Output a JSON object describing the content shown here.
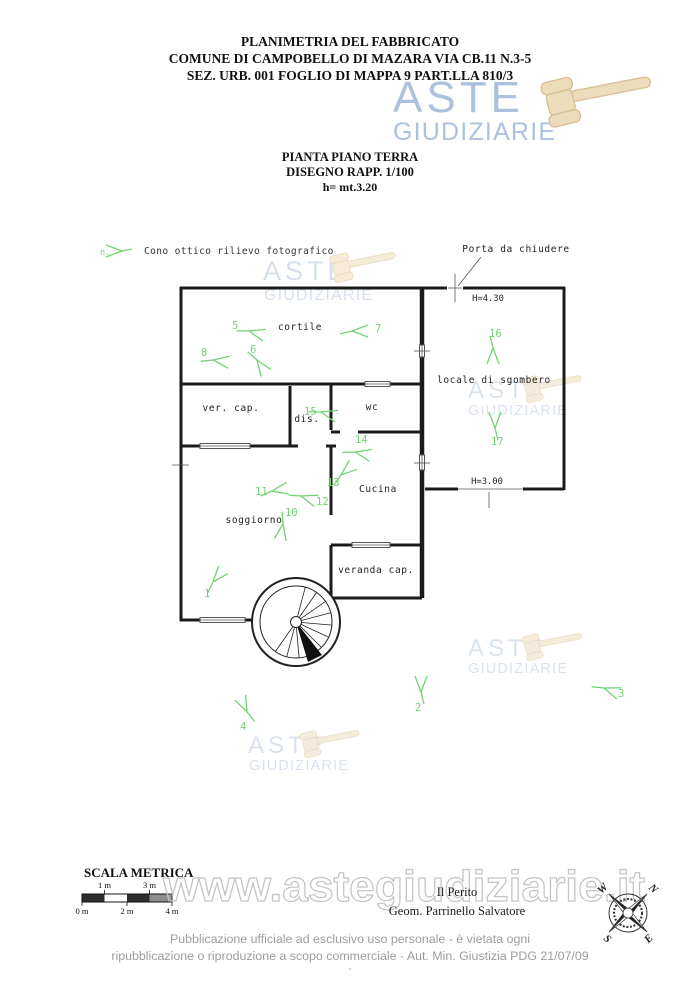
{
  "header": {
    "line1": "PLANIMETRIA DEL FABBRICATO",
    "line2": "COMUNE DI CAMPOBELLO DI MAZARA VIA CB.11 N.3-5",
    "line3": "SEZ. URB. 001 FOGLIO DI MAPPA 9 PART.LLA 810/3"
  },
  "subtitle": {
    "line1": "PIANTA PIANO TERRA",
    "line2": "DISEGNO RAPP. 1/100",
    "line3": "h= mt.3.20"
  },
  "logo": {
    "line1": "ASTE",
    "line2": "GIUDIZIARIE",
    "text_color": "#a9bedd",
    "gavel_color": "#eddbb8"
  },
  "legend": {
    "marker_label": "n.",
    "text": "Cono ottico rilievo fotografico"
  },
  "plan": {
    "door_note": "Porta da chiudere",
    "height_top": "H=4.30",
    "height_bottom": "H=3.00",
    "marker_color": "#72d372",
    "rooms": {
      "cortile": "cortile",
      "ver_cap": "ver. cap.",
      "dis": "dis.",
      "wc": "wc",
      "locale": "locale di sgombero",
      "cucina": "Cucina",
      "soggiorno": "soggiorno",
      "veranda": "veranda cap."
    },
    "markers": [
      {
        "label": "1",
        "x": 213,
        "y": 582,
        "r": -50,
        "lx": -9,
        "ly": 15
      },
      {
        "label": "2",
        "x": 421,
        "y": 692,
        "r": -90,
        "lx": -6,
        "ly": 19
      },
      {
        "label": "3",
        "x": 604,
        "y": 688,
        "r": 20,
        "lx": 14,
        "ly": 9
      },
      {
        "label": "4",
        "x": 247,
        "y": 712,
        "r": -115,
        "lx": -7,
        "ly": 18
      },
      {
        "label": "5",
        "x": 249,
        "y": 331,
        "r": 15,
        "lx": -17,
        "ly": -2
      },
      {
        "label": "6",
        "x": 257,
        "y": 360,
        "r": 55,
        "lx": -7,
        "ly": -7
      },
      {
        "label": "7",
        "x": 352,
        "y": 331,
        "r": 0,
        "lx": 23,
        "ly": 1
      },
      {
        "label": "8",
        "x": 213,
        "y": 360,
        "r": 8,
        "lx": -12,
        "ly": -4
      },
      {
        "label": "10",
        "x": 283,
        "y": 524,
        "r": 100,
        "lx": 2,
        "ly": -8
      },
      {
        "label": "11",
        "x": 272,
        "y": 491,
        "r": -10,
        "lx": -17,
        "ly": 4
      },
      {
        "label": "12",
        "x": 301,
        "y": 496,
        "r": 18,
        "lx": 15,
        "ly": 9
      },
      {
        "label": "13",
        "x": 341,
        "y": 475,
        "r": -40,
        "lx": -14,
        "ly": 11
      },
      {
        "label": "14",
        "x": 355,
        "y": 452,
        "r": 12,
        "lx": 0,
        "ly": -9
      },
      {
        "label": "15",
        "x": 321,
        "y": 412,
        "r": 15,
        "lx": -17,
        "ly": 3
      },
      {
        "label": "16",
        "x": 493,
        "y": 348,
        "r": 90,
        "lx": -4,
        "ly": -11
      },
      {
        "label": "17",
        "x": 495,
        "y": 428,
        "r": -90,
        "lx": -4,
        "ly": 17
      }
    ]
  },
  "scale_bar": {
    "title": "SCALA METRICA",
    "labels_top": [
      "1 m",
      "3 m"
    ],
    "labels_bottom": [
      "0 m",
      "2 m",
      "4 m"
    ]
  },
  "watermark": {
    "url": "www.astegiudiziarie.it"
  },
  "signature": {
    "line1": "Il Perito",
    "line2": "Geom. Parrinello Salvatore"
  },
  "compass": {
    "n": "N",
    "s": "S",
    "e": "E",
    "w": "W"
  },
  "footer": {
    "line1": "Pubblicazione ufficiale ad esclusivo uso personale - è vietata ogni",
    "line2": "ripubblicazione o riproduzione a scopo commerciale - Aut. Min. Giustizia PDG 21/07/09",
    "line3": "-"
  }
}
